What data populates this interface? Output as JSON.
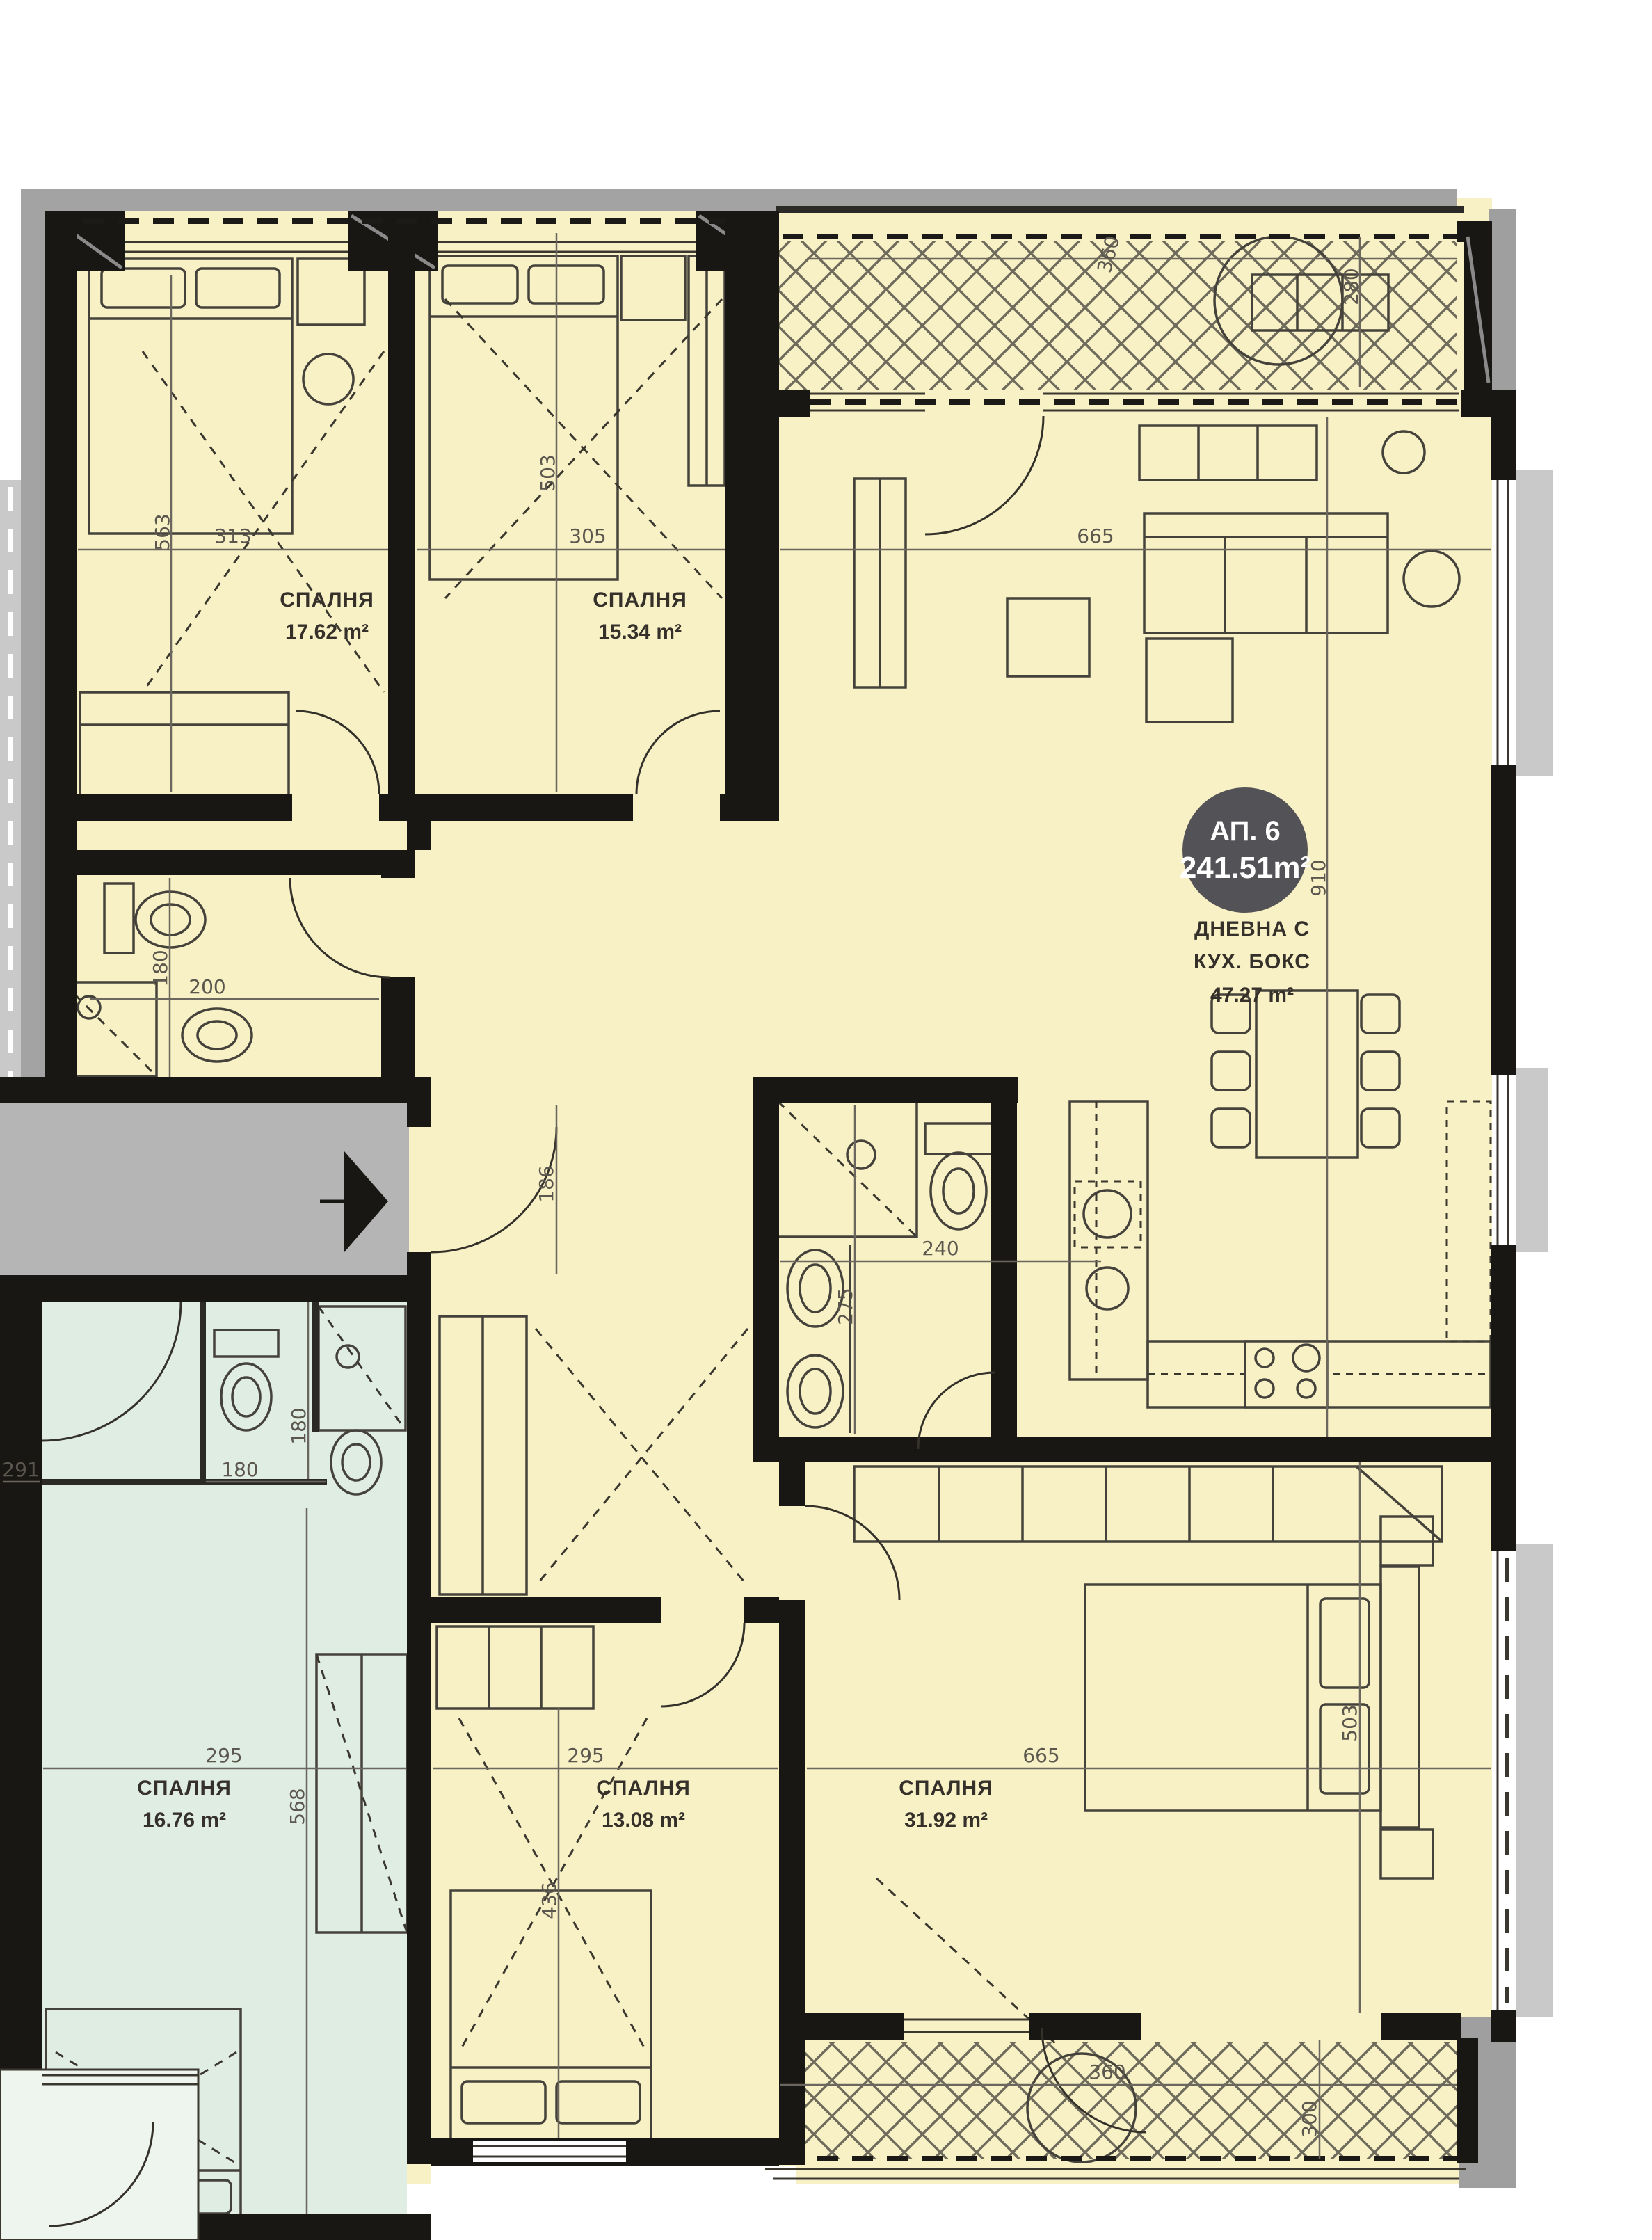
{
  "badge": {
    "unit": "АП. 6",
    "area": "241.51m²"
  },
  "rooms": {
    "bedroom_17": {
      "name": "СПАЛНЯ",
      "area": "17.62 m²"
    },
    "bedroom_15": {
      "name": "СПАЛНЯ",
      "area": "15.34 m²"
    },
    "living": {
      "line1": "ДНЕВНА С",
      "line2": "КУХ. БОКС",
      "area": "47.27 m²"
    },
    "bedroom_31": {
      "name": "СПАЛНЯ",
      "area": "31.92 m²"
    },
    "bedroom_13": {
      "name": "СПАЛНЯ",
      "area": "13.08 m²"
    },
    "bedroom_16": {
      "name": "СПАЛНЯ",
      "area": "16.76 m²"
    }
  },
  "dims": {
    "d313": "313",
    "d563": "563",
    "d305": "305",
    "d503_top": "503",
    "d665_top": "665",
    "d360_top": "360",
    "d280": "280",
    "d910": "910",
    "d186": "186",
    "d180_bath": "180",
    "d200": "200",
    "d240": "240",
    "d275": "275",
    "d291": "291",
    "d180_wc_v": "180",
    "d180_wc_h": "180",
    "d295_teal": "295",
    "d568": "568",
    "d295_mid": "295",
    "d436": "436",
    "d665_bottom": "665",
    "d503_bottom": "503",
    "d360_bottom": "360",
    "d300": "300"
  },
  "colors": {
    "room_fill": "#f8f1c5",
    "teal_fill": "#e0ede2",
    "corridor_gray": "#b5b5b5",
    "wall_black": "#191713",
    "badge_bg": "#4a4950",
    "dim_text": "#5b574e"
  }
}
